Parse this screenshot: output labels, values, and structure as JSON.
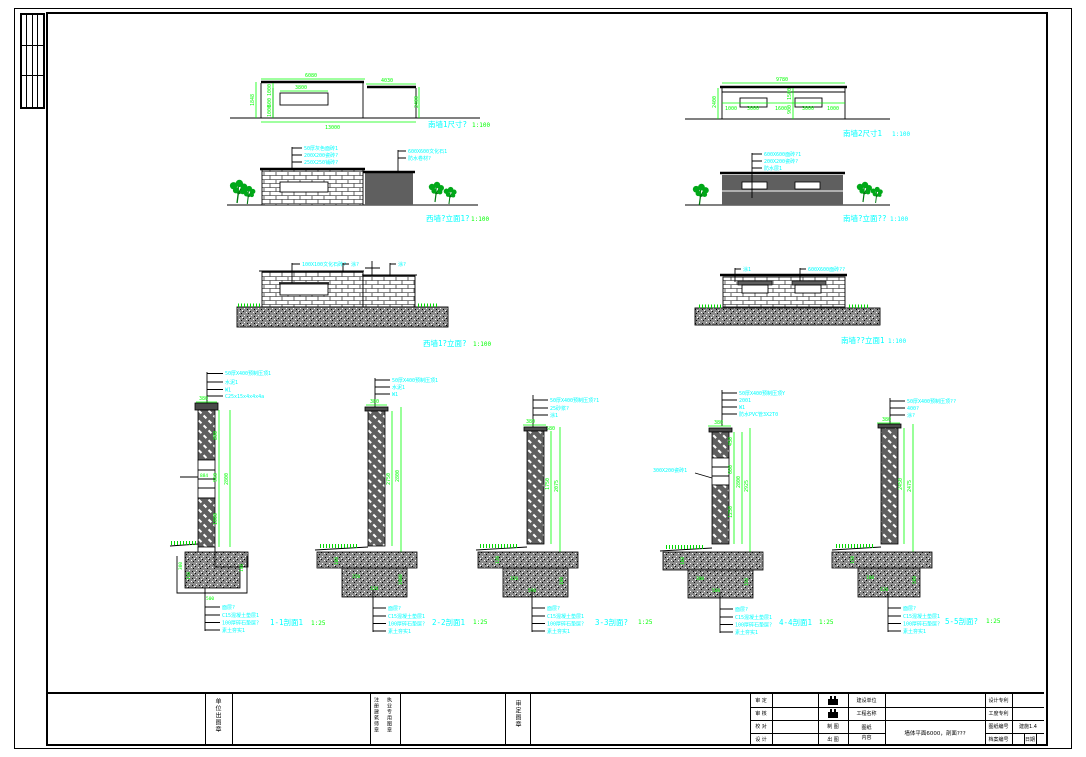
{
  "drawings": {
    "shared": {
      "scale_elev": "1:100"
    },
    "a": {
      "title": "南墙1尺寸?",
      "dims": {
        "top": "6080",
        "top2": "4030",
        "win": "3800",
        "total": "13000",
        "left": "1848",
        "stack": [
          "1000",
          "600",
          "1000"
        ],
        "right": "2400"
      }
    },
    "b": {
      "title": "南墙2尺寸1",
      "dims": {
        "top": "9780",
        "segs": [
          "1000",
          "3000",
          "1600",
          "3000",
          "1000"
        ],
        "left": "2400",
        "mid": [
          "1500",
          "900"
        ]
      }
    },
    "c": {
      "title": "西墙?立面1?",
      "callouts_left": [
        "50厚灰色面砖1",
        "200X200瓷砖?",
        "250X250铺砖?"
      ],
      "callouts_right": [
        "600X600文化石1",
        "防水卷材?"
      ]
    },
    "d": {
      "title": "南墙?立面??",
      "callouts": [
        "600X600面砖?1",
        "200X200瓷砖?",
        "防水层1"
      ]
    },
    "e": {
      "title": "西墙1?立面?",
      "callouts": [
        "100X100文化石砖?",
        "涂?",
        "涂?"
      ]
    },
    "f": {
      "title": "南墙??立面1",
      "callouts": [
        "涂1",
        "600X600面砖??"
      ]
    }
  },
  "sections": {
    "shared": {
      "scale": "1:25",
      "top_width": "380",
      "footing_callouts": [
        "面层?",
        "C15混凝土垫层1",
        "100厚碎石垫层?",
        "素土夯实1"
      ]
    },
    "s1": {
      "title": "1-1剖面1",
      "callouts_top": [
        "50厚X400预制压顶1",
        "水泥1",
        "W1",
        "C25x15x4x4x4a"
      ],
      "dims": {
        "stack": [
          "800",
          "960",
          "1000"
        ],
        "win": "884",
        "total": "2800"
      },
      "footing_dims": [
        "300",
        "150",
        "500",
        "180"
      ]
    },
    "s2": {
      "title": "2-2剖面1",
      "callouts_top": [
        "50厚X400预制压顶1",
        "水泥1",
        "W1"
      ],
      "dims": {
        "h1": "2750",
        "h2": "2800"
      },
      "footing_dims": [
        "100",
        "250",
        "1000",
        "120"
      ]
    },
    "s3": {
      "title": "3-3剖面?",
      "callouts_top": [
        "50厚X400预制压顶?1",
        "25砂浆?",
        "涂1"
      ],
      "dims": {
        "h1": "1750",
        "h2": "2075",
        "w": "580"
      },
      "footing_dims": [
        "120",
        "150",
        "100",
        "500"
      ]
    },
    "s4": {
      "title": "4-4剖面1",
      "callouts_top": [
        "50厚X400预制压顶Y",
        "2001",
        "W1",
        "防水PVC管3X2T0"
      ],
      "callout_left": "300X200瓷砖1",
      "dims": {
        "stack": [
          "450",
          "600",
          "1250"
        ],
        "h1": "2800",
        "h2": "2925"
      },
      "footing_dims": [
        "100",
        "300",
        "150",
        "500"
      ]
    },
    "s5": {
      "title": "5-5剖面?",
      "callouts_top": [
        "50厚X400预制压顶??",
        "400?",
        "涂?"
      ],
      "dims": {
        "h1": "2450",
        "h2": "2475"
      },
      "footing_dims": [
        "150",
        "100",
        "500",
        "120"
      ]
    }
  },
  "title_block": {
    "stamp_strip_1": "单位出图章",
    "stamp_strip_2a": "注册建筑师章",
    "stamp_strip_2b": "执业专用图章",
    "stamp_strip_3": "审定图章",
    "approval_labels": [
      "审 定",
      "审 核",
      "校 对",
      "设 计"
    ],
    "draw_labels": [
      "制 图",
      "出 图"
    ],
    "info_labels": [
      "建设单位",
      "工程名称",
      "图纸",
      "内容"
    ],
    "content_value": "墙体平面6000，剖面???",
    "right_labels": [
      "设计专利",
      "工度专利",
      "图纸编号",
      "档案编号"
    ],
    "drawing_no": "建施1.4",
    "date_label": "日期"
  }
}
